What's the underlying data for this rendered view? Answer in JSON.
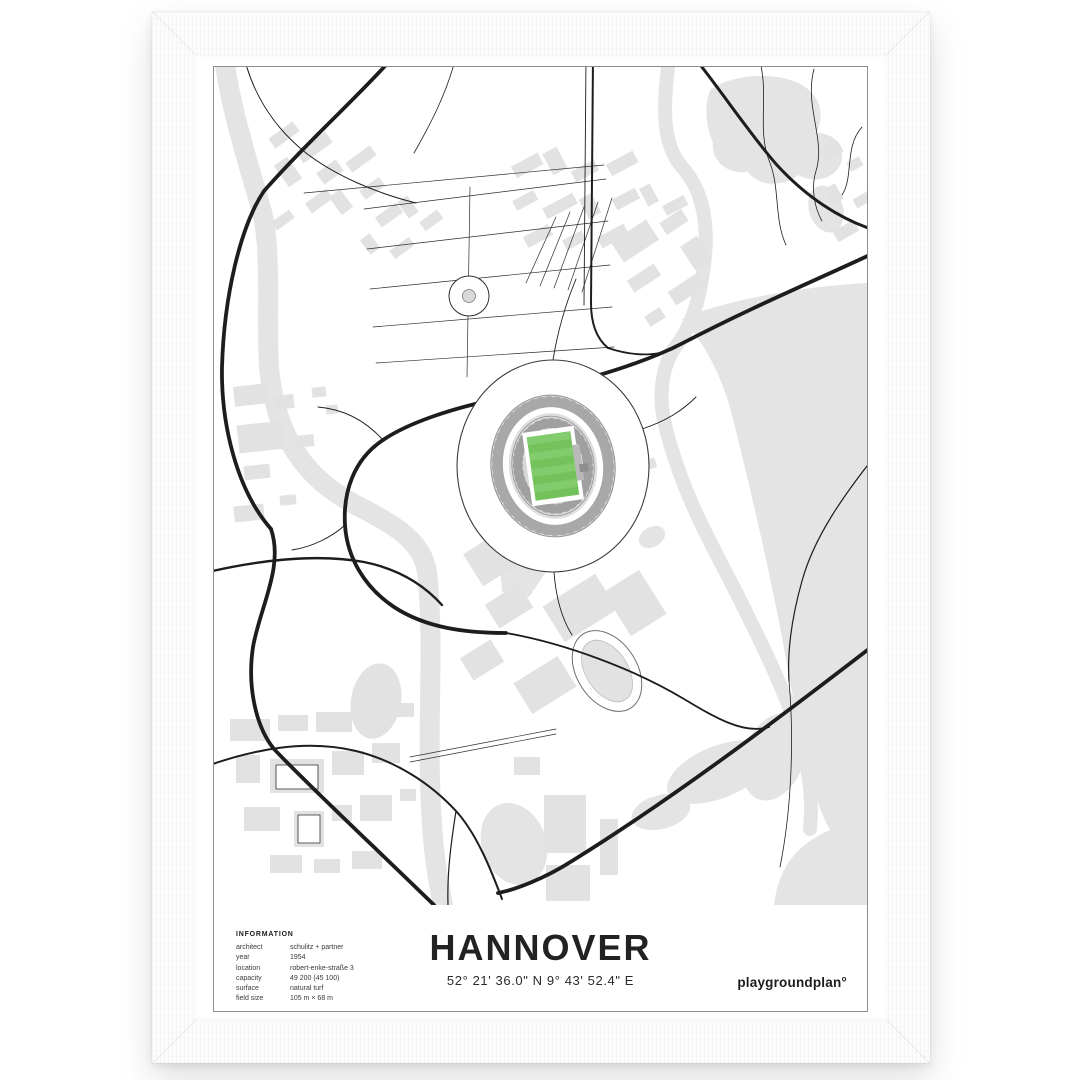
{
  "poster": {
    "title": "HANNOVER",
    "coordinates": "52° 21' 36.0\" N  9° 43' 52.4\" E",
    "brand": "playgroundplan°",
    "info": {
      "heading": "INFORMATION",
      "rows": [
        {
          "label": "architect",
          "value": "schulitz + partner"
        },
        {
          "label": "year",
          "value": "1954"
        },
        {
          "label": "location",
          "value": "robert-enke-straße 3"
        },
        {
          "label": "capacity",
          "value": "49 200 (45 100)"
        },
        {
          "label": "surface",
          "value": "natural turf"
        },
        {
          "label": "field size",
          "value": "105 m × 68 m"
        }
      ]
    },
    "colors": {
      "pitch_green": "#74c25b",
      "pitch_stripe": "#83cc6d",
      "map_gray": "#e4e4e4",
      "road_black": "#1d1d1d",
      "box_border_gray": "#8d8d8d"
    }
  }
}
